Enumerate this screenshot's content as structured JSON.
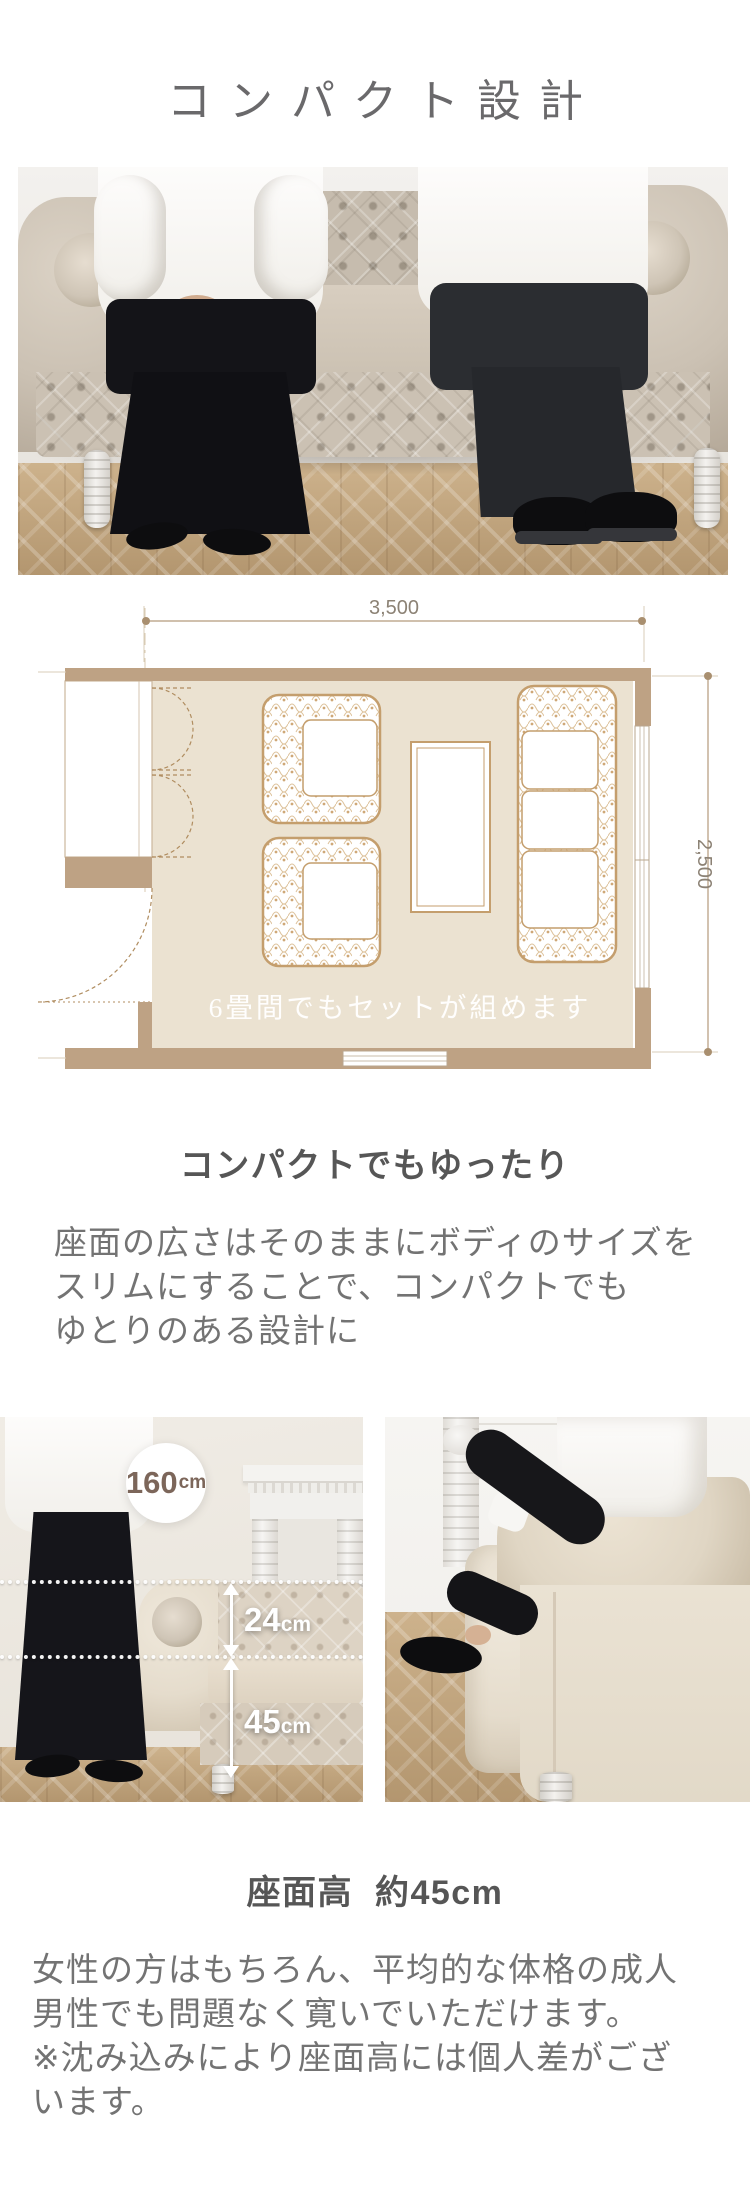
{
  "page": {
    "title": "コンパクト設計"
  },
  "floorplan": {
    "width_label": "3,500",
    "height_label": "2,500",
    "caption": "6畳間でもセットが組めます"
  },
  "compact_section": {
    "heading": "コンパクトでもゆったり",
    "body_lines": [
      "座面の広さはそのままにボディのサイズを",
      "スリムにすることで、コンパクトでも",
      "ゆとりのある設計に"
    ]
  },
  "measurements": {
    "person_height_value": "160",
    "person_height_unit": "cm",
    "back_height_value": "24",
    "back_height_unit": "cm",
    "seat_height_value": "45",
    "seat_height_unit": "cm"
  },
  "seat_height_section": {
    "heading": "座面高  約45cm",
    "body_lines": [
      "女性の方はもちろん、平均的な体格の成人",
      "男性でも問題なく寛いでいただけます。",
      "※沈み込みにより座面高には個人差がござ",
      "います。"
    ]
  },
  "colors": {
    "accent_tan": "#bea284",
    "plan_floor": "#ebe2d1",
    "plan_line": "#c49e6d",
    "text_primary": "#565656",
    "text_body": "#737373",
    "annotation_brown": "#7c665a"
  }
}
